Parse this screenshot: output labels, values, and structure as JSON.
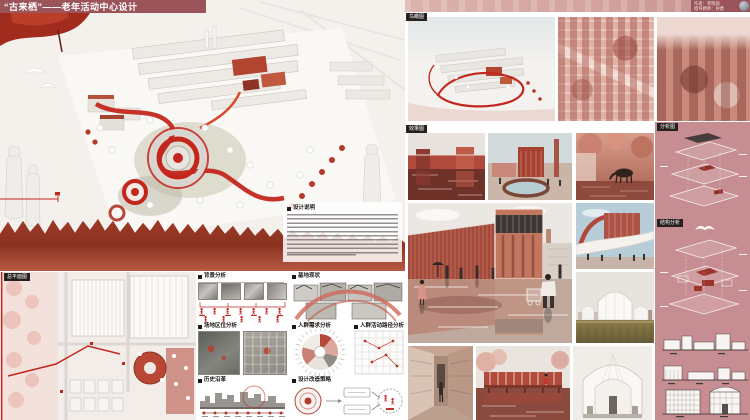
{
  "header": {
    "title": "“古来栖”——老年活动中心设计"
  },
  "credits": {
    "author": "作者：李晓雨",
    "advisor": "指导教师：孙勇"
  },
  "left_panel": {
    "design_notes_title": "设计说明",
    "site_plan_label": "总平面图",
    "sections": {
      "background": "背景分析",
      "site_status": "基地现状",
      "location": "场地区位分析",
      "needs": "人群需求分析",
      "paths": "人群活动路径分析",
      "history": "历史沿革",
      "strategy": "设计改造策略"
    }
  },
  "right_panel": {
    "labels": {
      "aerial": "鸟瞰图",
      "renders": "效果图",
      "axon": "分析图",
      "structure": "结构分析"
    }
  },
  "colors": {
    "maroon": "#9a545a",
    "accent_red": "#c3261c",
    "panel_pink": "#c68e92"
  }
}
